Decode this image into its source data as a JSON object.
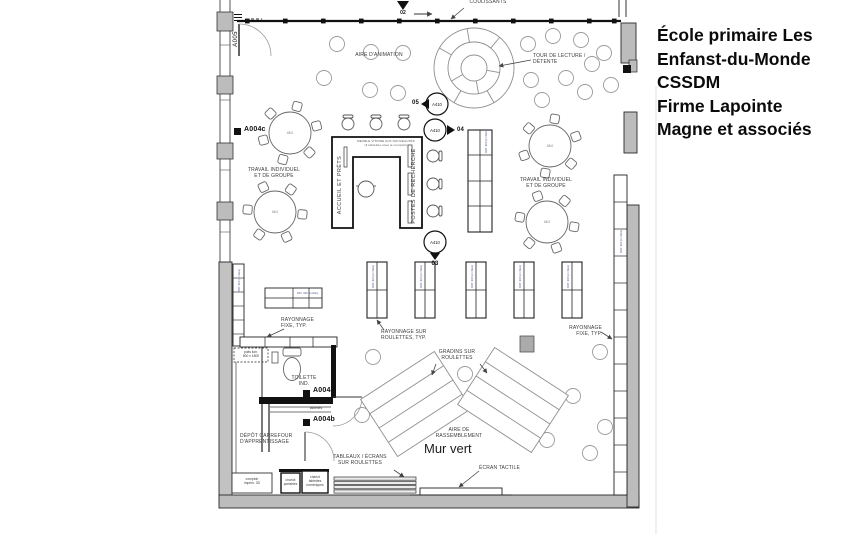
{
  "title_block": {
    "lines": [
      "École primaire Les",
      "Enfanst-du-Monde",
      "CSSDM",
      "Firme Lapointe",
      "Magne et associés"
    ]
  },
  "plan": {
    "areas": {
      "aire_animation": "AIRE D'ANIMATION",
      "tour_lecture": "TOUR DE LECTURE /\nDÉTENTE",
      "travail_groupe": "TRAVAIL INDIVIDUEL\nET DE GROUPE",
      "aire_rassemblement": "AIRE DE\nRASSEMBLEMENT",
      "depot": "DÉPÔT CARREFOUR\nD'APPRENTISSAGE",
      "toilette": "TOILETTE\nIND.",
      "mur_vert": "Mur vert"
    },
    "desk": {
      "accueil": "ACCUEIL ET PRÊTS",
      "postes": "POSTES DE RECHERCHE",
      "note": "MEUBLE VITRINE AUX NOUVEAUTÉS\n(3 tablettes sous le comptoir)"
    },
    "equipment": {
      "coulissants": "COULISSANTS",
      "rayonnage_roulettes": "RAYONNAGE SUR\nROULETTES, TYP.",
      "rayonnage_fixe": "RAYONNAGE\nFIXE, TYP.",
      "gradins": "GRADINS SUR\nROULETTES",
      "tableaux": "TABLEAUX / ÉCRANS\nSUR ROULETTES",
      "ecran_tactile": "ÉCRAN TACTILE",
      "comptoir_imprim": "comptoir\nimprim. 3D",
      "chariot_portables": "chariot\nportables",
      "chariot_tablettes": "chariot\ntablettes\nnumériques",
      "puits": "puits lum.\n600 x 1800",
      "tablettes": "tablettes",
      "table_size": "48.0",
      "shelf_tag": "RAY. 900 (2 côtés)"
    },
    "tags": {
      "a005": "A005",
      "a004a": "A004a",
      "a004b": "A004b",
      "a004c": "A004c"
    },
    "callouts": {
      "ref": "A410",
      "n02": "02",
      "n03": "03",
      "n04": "04",
      "n05": "05"
    }
  },
  "colors": {
    "wall_gray": "#bcbcbc",
    "line": "#1a1a1a",
    "label": "#3c3c3c",
    "light_line": "#9a9a9a"
  }
}
